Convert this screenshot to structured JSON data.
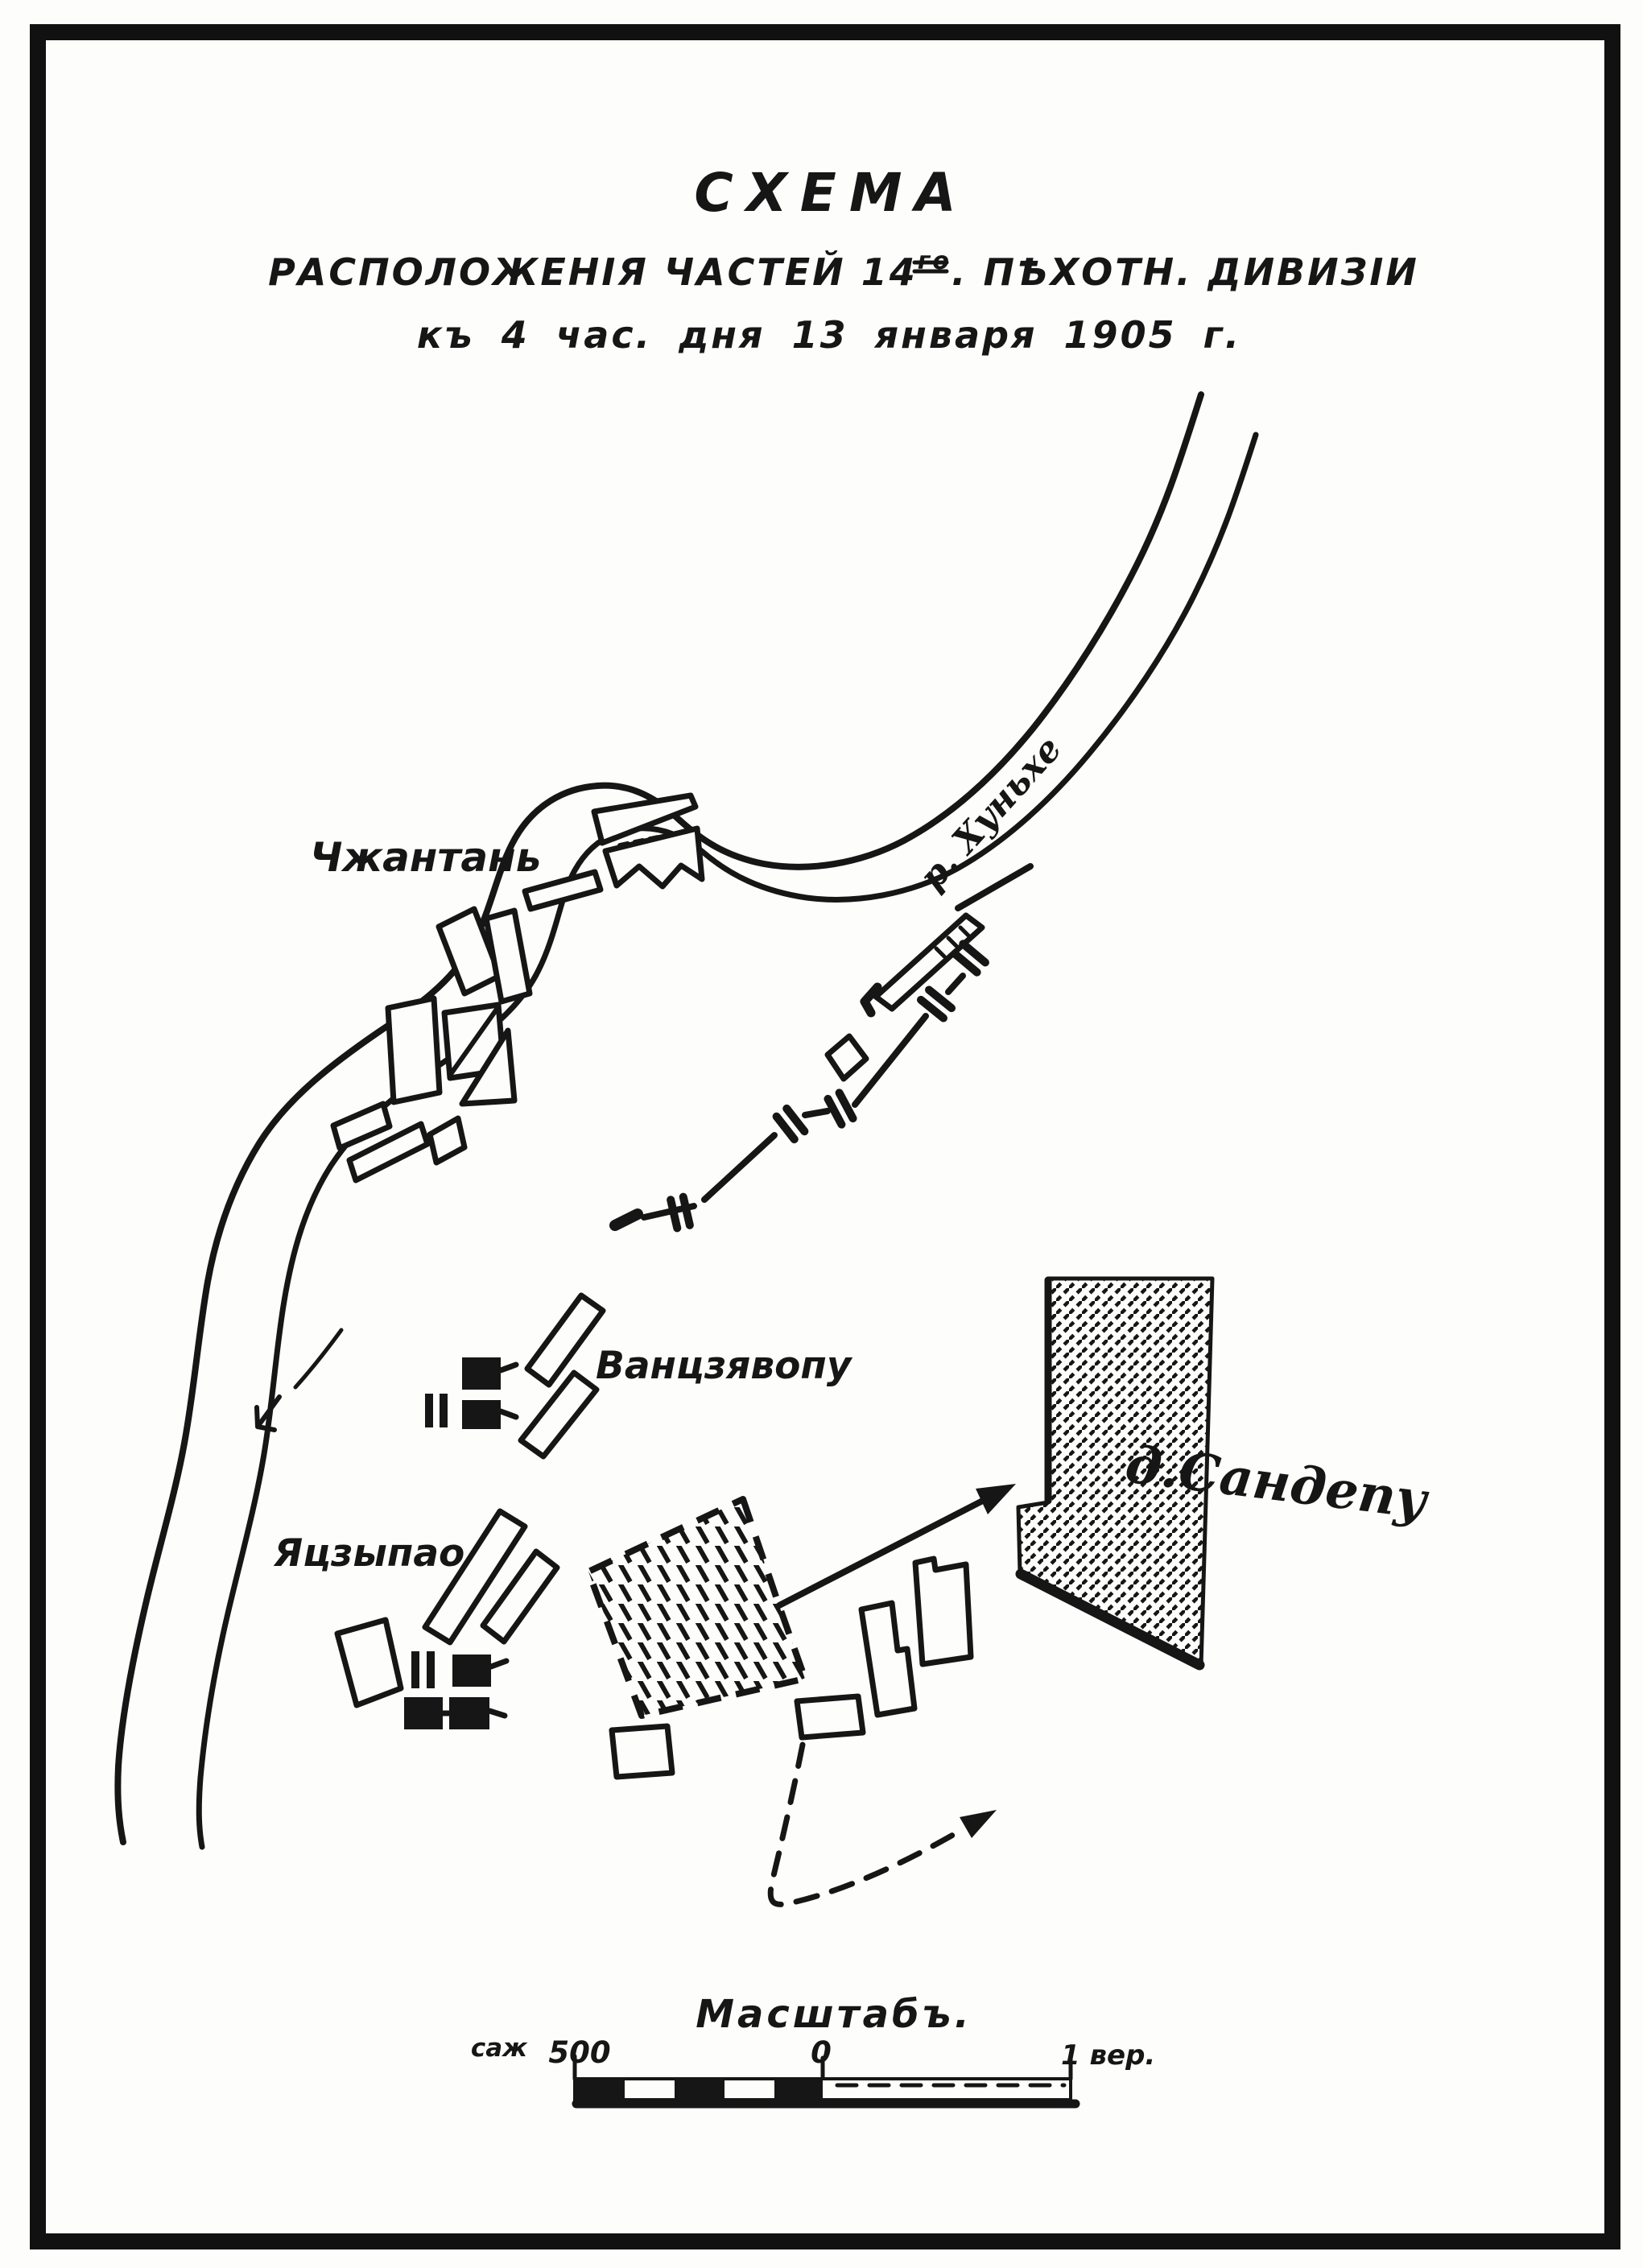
{
  "document": {
    "kind": "scanned historical military map",
    "language": "Russian (pre-1918 orthography)"
  },
  "title": {
    "line1": "СХЕМА",
    "line2_pre": "РАСПОЛОЖЕНІЯ ЧАСТЕЙ 14",
    "line2_sup": "го",
    "line2_post": ". ПѢХОТН. ДИВИЗІИ",
    "line3": "къ 4 час. дня 13 января 1905 г."
  },
  "labels": {
    "river": "р. Хуньхе",
    "village_chzhantan": "Чжантань",
    "village_vantszyavopu": "Ванцзявопу",
    "village_yatszypao": "Яцзыпао",
    "village_sandepu": "д.Сандепу"
  },
  "scale_bar": {
    "title": "Масштабъ.",
    "left_unit": "саж",
    "left_value": "500",
    "origin": "0",
    "right_value": "1 вер."
  },
  "map_symbols": {
    "unit_marker": "black-rectangle-with-flag-tick",
    "picket_line_marker": "double-bar-tick-on-line",
    "hatched_area_large": "village-sandepu-built-area",
    "hatched_area_dashed_border": "occupied-position-area",
    "flow_arrow": "river-flow-direction-arrow",
    "movement_arrow_solid": "advance-direction-arrow",
    "movement_arrow_dashed": "planned-movement-arrow"
  },
  "colors": {
    "ink": "#161616",
    "paper": "#fdfdfb"
  }
}
